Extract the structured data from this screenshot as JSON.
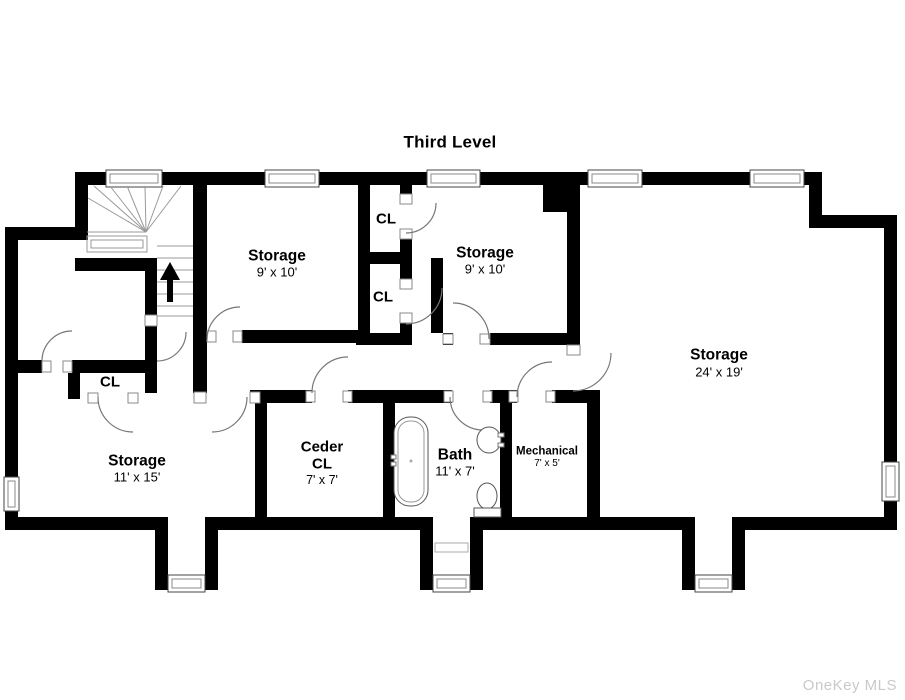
{
  "title": "Third Level",
  "watermark": "OneKey MLS",
  "rooms": {
    "storage_top_left": {
      "name": "Storage",
      "dims": "9' x 10'"
    },
    "storage_top_mid": {
      "name": "Storage",
      "dims": "9' x 10'"
    },
    "storage_large": {
      "name": "Storage",
      "dims": "24' x 19'"
    },
    "storage_lower": {
      "name": "Storage",
      "dims": "11' x 15'"
    },
    "ceder_closet": {
      "line1": "Ceder",
      "line2": "CL",
      "dims": "7' x 7'"
    },
    "bath": {
      "name": "Bath",
      "dims": "11' x 7'"
    },
    "mechanical": {
      "name": "Mechanical",
      "dims": "7' x 5'"
    }
  },
  "closets": {
    "upper": "CL",
    "middle": "CL",
    "left": "CL"
  },
  "colors": {
    "wall": "#000000",
    "background": "#ffffff",
    "stair_lines": "#999999",
    "door_arc": "#777777",
    "fixture_outline": "#555555",
    "watermark": "#c9c9c9"
  },
  "symbols": {
    "stair_direction": "up-arrow"
  }
}
